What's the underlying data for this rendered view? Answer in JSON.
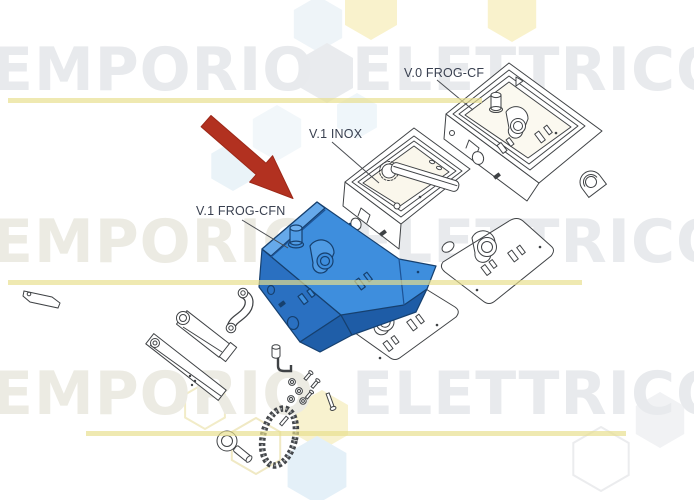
{
  "product_image": {
    "type": "exploded-parts-diagram",
    "watermark": {
      "word_left": "EMPORIO",
      "word_right": "ELETTRICO"
    },
    "labels": {
      "box_top": "V.0 FROG-CF",
      "box_middle": "V.1 INOX",
      "box_highlighted": "V.1 FROG-CFN"
    },
    "colors": {
      "highlight_blue": "#3e8edd",
      "highlight_blue_dark": "#2a70c1",
      "highlight_outline": "#16406f",
      "arrow_red": "#b23120",
      "line_art": "#3f4245",
      "watermark_gray": "#e8eaed",
      "underline_yellow": "#e8de8c"
    }
  }
}
